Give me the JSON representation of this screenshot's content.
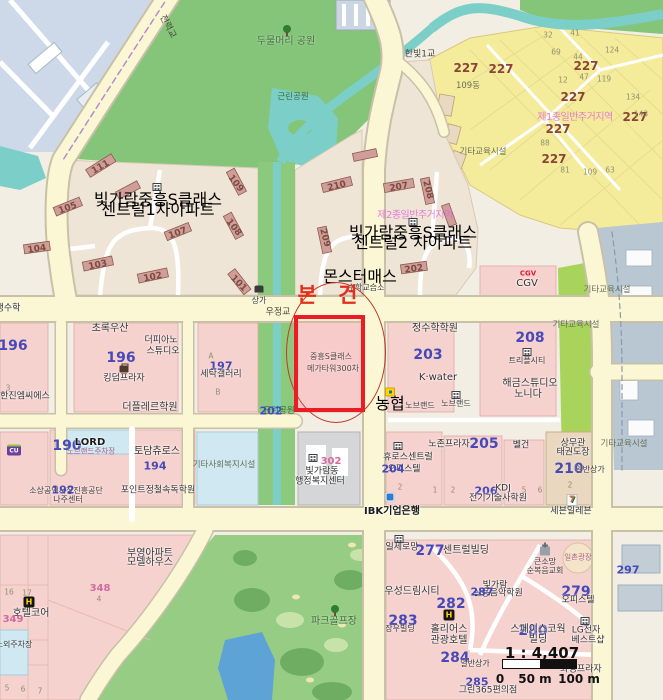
{
  "annotation": {
    "label": "본 건"
  },
  "scale": {
    "ratio": "1 : 4,407",
    "t0": "0",
    "t1": "50 m",
    "t2": "100 m"
  },
  "icons": {
    "hotel": "H",
    "cu": "CU",
    "seven": "7"
  },
  "colors": {
    "subject_box": "#ec1c24",
    "road_fill": "#fbf7d4",
    "park": "#84c57a",
    "water": "#7ccfc9",
    "lake": "#5ea3d6",
    "parcel_pink": "#f6d2cf",
    "parcel_yellow": "#f5ec9b",
    "num_blue": "#4749b8",
    "num_maroon": "#8a4536"
  },
  "labels": [
    {
      "n": "park-dumulmeori",
      "t": "두물머리 공원",
      "x": 286,
      "y": 42,
      "c": "park"
    },
    {
      "n": "park-geunrin-top",
      "t": "근린공원",
      "x": 293,
      "y": 97,
      "c": "park-sm"
    },
    {
      "n": "bridge-jeonryeok",
      "t": "전력교",
      "x": 167,
      "y": 27,
      "c": "road",
      "r": 62
    },
    {
      "n": "bridge-hanbit1",
      "t": "한빛1교",
      "x": 420,
      "y": 55,
      "c": "road"
    },
    {
      "t": "109동",
      "x": 468,
      "y": 86,
      "c": "misc"
    },
    {
      "t": "기타교육시설",
      "x": 483,
      "y": 152,
      "c": "misc"
    },
    {
      "n": "zone-yellow",
      "t": "제1종일반주거지역",
      "x": 575,
      "y": 118,
      "c": "zone"
    },
    {
      "t": "227",
      "x": 466,
      "y": 68,
      "c": "num-maroon"
    },
    {
      "t": "227",
      "x": 501,
      "y": 69,
      "c": "num-maroon"
    },
    {
      "t": "227",
      "x": 586,
      "y": 66,
      "c": "num-maroon"
    },
    {
      "t": "227",
      "x": 573,
      "y": 97,
      "c": "num-maroon"
    },
    {
      "t": "227",
      "x": 558,
      "y": 129,
      "c": "num-maroon"
    },
    {
      "t": "227",
      "x": 635,
      "y": 117,
      "c": "num-maroon"
    },
    {
      "t": "227",
      "x": 554,
      "y": 159,
      "c": "num-maroon"
    },
    {
      "t": "32",
      "x": 548,
      "y": 35,
      "c": "num-gray"
    },
    {
      "t": "41",
      "x": 575,
      "y": 33,
      "c": "num-gray"
    },
    {
      "t": "69",
      "x": 556,
      "y": 52,
      "c": "num-gray"
    },
    {
      "t": "44",
      "x": 578,
      "y": 57,
      "c": "num-gray"
    },
    {
      "t": "12",
      "x": 563,
      "y": 80,
      "c": "num-gray"
    },
    {
      "t": "47",
      "x": 584,
      "y": 77,
      "c": "num-gray"
    },
    {
      "t": "124",
      "x": 612,
      "y": 50,
      "c": "num-gray"
    },
    {
      "t": "119",
      "x": 604,
      "y": 79,
      "c": "num-gray"
    },
    {
      "t": "134",
      "x": 633,
      "y": 97,
      "c": "num-gray"
    },
    {
      "t": "143",
      "x": 641,
      "y": 114,
      "c": "num-gray"
    },
    {
      "t": "88",
      "x": 545,
      "y": 143,
      "c": "num-gray"
    },
    {
      "t": "81",
      "x": 565,
      "y": 170,
      "c": "num-gray"
    },
    {
      "t": "109",
      "x": 590,
      "y": 172,
      "c": "num-gray"
    },
    {
      "t": "63",
      "x": 610,
      "y": 170,
      "c": "num-gray"
    },
    {
      "n": "complex1-name1",
      "t": "빛가람중흥S클래스",
      "x": 158,
      "y": 200,
      "c": "complex"
    },
    {
      "n": "complex1-name2",
      "t": "센트럴1차아파트",
      "x": 158,
      "y": 210,
      "c": "complex"
    },
    {
      "n": "complex2-name1",
      "t": "빛가람중흥S클래스",
      "x": 413,
      "y": 233,
      "c": "complex"
    },
    {
      "n": "complex2-name2",
      "t": "센트럴2 차아파트",
      "x": 413,
      "y": 243,
      "c": "complex"
    },
    {
      "n": "zone-residential2",
      "t": "제2종일반주거지역",
      "x": 415,
      "y": 216,
      "c": "zone"
    },
    {
      "t": "111",
      "x": 101,
      "y": 168,
      "c": "num-bldg",
      "r": -30
    },
    {
      "t": "105",
      "x": 68,
      "y": 209,
      "c": "num-bldg",
      "r": -20
    },
    {
      "t": "104",
      "x": 37,
      "y": 250,
      "c": "num-bldg",
      "r": -8
    },
    {
      "t": "103",
      "x": 98,
      "y": 266,
      "c": "num-bldg",
      "r": -12
    },
    {
      "t": "102",
      "x": 153,
      "y": 278,
      "c": "num-bldg",
      "r": -12
    },
    {
      "t": "107",
      "x": 178,
      "y": 234,
      "c": "num-bldg",
      "r": -20
    },
    {
      "t": "109",
      "x": 235,
      "y": 184,
      "c": "num-bldg",
      "r": 52
    },
    {
      "t": "108",
      "x": 233,
      "y": 228,
      "c": "num-bldg",
      "r": 52
    },
    {
      "t": "101",
      "x": 238,
      "y": 284,
      "c": "num-bldg",
      "r": 45
    },
    {
      "t": "210",
      "x": 337,
      "y": 187,
      "c": "num-bldg",
      "r": -14
    },
    {
      "t": "207",
      "x": 399,
      "y": 188,
      "c": "num-bldg",
      "r": -10
    },
    {
      "t": "208",
      "x": 427,
      "y": 190,
      "c": "num-bldg",
      "r": 75
    },
    {
      "t": "209",
      "x": 324,
      "y": 238,
      "c": "num-bldg",
      "r": 75
    },
    {
      "t": "202",
      "x": 414,
      "y": 270,
      "c": "num-bldg",
      "r": -8
    },
    {
      "n": "poi-monster-math",
      "t": "몬스터매스",
      "x": 360,
      "y": 277,
      "c": "poi"
    },
    {
      "t": "수학교습소",
      "x": 366,
      "y": 288,
      "c": "name-xs"
    },
    {
      "t": "상가",
      "x": 259,
      "y": 301,
      "c": "name-xs"
    },
    {
      "n": "bridge-ujeong",
      "t": "우정교",
      "x": 278,
      "y": 313,
      "c": "road"
    },
    {
      "t": "생수학",
      "x": 8,
      "y": 309,
      "c": "name-sm"
    },
    {
      "t": "196",
      "x": 13,
      "y": 346,
      "c": "num-blue-lg"
    },
    {
      "t": "초록우산",
      "x": 110,
      "y": 329,
      "c": "name"
    },
    {
      "t": "더피아노",
      "x": 161,
      "y": 341,
      "c": "name-sm"
    },
    {
      "t": "스튜디오",
      "x": 163,
      "y": 352,
      "c": "name-sm"
    },
    {
      "t": "196",
      "x": 121,
      "y": 358,
      "c": "num-blue-lg"
    },
    {
      "t": "킹덤프라자",
      "x": 124,
      "y": 379,
      "c": "name-sm"
    },
    {
      "t": "한진엠씨에스",
      "x": 25,
      "y": 397,
      "c": "name-sm"
    },
    {
      "t": "더플레르학원",
      "x": 150,
      "y": 408,
      "c": "name"
    },
    {
      "t": "197",
      "x": 221,
      "y": 366,
      "c": "num-blue"
    },
    {
      "t": "A",
      "x": 211,
      "y": 356,
      "c": "num-gray"
    },
    {
      "t": "B",
      "x": 218,
      "y": 392,
      "c": "num-gray"
    },
    {
      "t": "세탁갤러리",
      "x": 221,
      "y": 375,
      "c": "name-sm"
    },
    {
      "t": "3",
      "x": 8,
      "y": 388,
      "c": "num-gray"
    },
    {
      "n": "poi-jeongsu-academy",
      "t": "정수학학원",
      "x": 435,
      "y": 329,
      "c": "name"
    },
    {
      "t": "203",
      "x": 428,
      "y": 355,
      "c": "num-blue-lg"
    },
    {
      "n": "poi-kwater",
      "t": "K·water",
      "x": 438,
      "y": 378,
      "c": "name"
    },
    {
      "n": "cgv-logo",
      "t": "CGV",
      "x": 528,
      "y": 274,
      "c": "cgv-logo"
    },
    {
      "n": "poi-cgv",
      "t": "CGV",
      "x": 527,
      "y": 284,
      "c": "name"
    },
    {
      "t": "208",
      "x": 530,
      "y": 338,
      "c": "num-blue-lg"
    },
    {
      "t": "트리플시티",
      "x": 527,
      "y": 361,
      "c": "name-xs"
    },
    {
      "t": "해금스튜디오",
      "x": 530,
      "y": 384,
      "c": "name"
    },
    {
      "t": "노니다",
      "x": 528,
      "y": 395,
      "c": "name"
    },
    {
      "t": "노브랜드",
      "x": 420,
      "y": 406,
      "c": "name-xs"
    },
    {
      "t": "노브랜드",
      "x": 456,
      "y": 404,
      "c": "name-xs"
    },
    {
      "n": "poi-nonghyup",
      "t": "농협",
      "x": 390,
      "y": 404,
      "c": "poi"
    },
    {
      "n": "park-geunrin-202",
      "t": "근린공원",
      "x": 279,
      "y": 411,
      "c": "park-sm"
    },
    {
      "t": "202",
      "x": 271,
      "y": 411,
      "c": "num-blue"
    },
    {
      "t": "기타교육시설",
      "x": 607,
      "y": 290,
      "c": "misc"
    },
    {
      "t": "기타교육시설",
      "x": 576,
      "y": 325,
      "c": "misc"
    },
    {
      "t": "기타교육시설",
      "x": 624,
      "y": 444,
      "c": "misc"
    },
    {
      "t": "기타사회복지시설",
      "x": 224,
      "y": 465,
      "c": "misc"
    },
    {
      "t": "302",
      "x": 331,
      "y": 462,
      "c": "num-pink"
    },
    {
      "n": "poi-admin-center1",
      "t": "빛가람동",
      "x": 322,
      "y": 472,
      "c": "name-sm"
    },
    {
      "n": "poi-admin-center2",
      "t": "행정복지센터",
      "x": 320,
      "y": 482,
      "c": "name-sm"
    },
    {
      "t": "190",
      "x": 67,
      "y": 446,
      "c": "num-blue-lg"
    },
    {
      "n": "poi-lord",
      "t": "LORD",
      "x": 90,
      "y": 443,
      "c": "brand"
    },
    {
      "t": "노브랜드주차장",
      "x": 91,
      "y": 451,
      "c": "tiny-pink"
    },
    {
      "t": "토담츄로스",
      "x": 157,
      "y": 452,
      "c": "name"
    },
    {
      "t": "194",
      "x": 155,
      "y": 466,
      "c": "num-blue"
    },
    {
      "t": "소상공인시장진흥공단",
      "x": 66,
      "y": 491,
      "c": "name-xs"
    },
    {
      "t": "192",
      "x": 63,
      "y": 490,
      "c": "num-blue"
    },
    {
      "t": "나주센터",
      "x": 68,
      "y": 500,
      "c": "name-xs"
    },
    {
      "t": "포인트정철속독학원",
      "x": 158,
      "y": 491,
      "c": "name-sm"
    },
    {
      "t": "휴로스센트럴",
      "x": 408,
      "y": 458,
      "c": "name-sm"
    },
    {
      "t": "오피스텔",
      "x": 404,
      "y": 470,
      "c": "name-sm"
    },
    {
      "t": "204",
      "x": 393,
      "y": 469,
      "c": "num-blue"
    },
    {
      "t": "2",
      "x": 400,
      "y": 487,
      "c": "num-gray"
    },
    {
      "t": "노존프라자",
      "x": 449,
      "y": 445,
      "c": "name-sm"
    },
    {
      "t": "205",
      "x": 484,
      "y": 444,
      "c": "num-blue-lg"
    },
    {
      "t": "벨건",
      "x": 521,
      "y": 446,
      "c": "name-sm"
    },
    {
      "t": "상무관",
      "x": 573,
      "y": 444,
      "c": "name-sm"
    },
    {
      "t": "태권도장",
      "x": 573,
      "y": 453,
      "c": "name-sm"
    },
    {
      "t": "210",
      "x": 569,
      "y": 469,
      "c": "num-blue-lg"
    },
    {
      "t": "일반상가",
      "x": 590,
      "y": 470,
      "c": "name-xs"
    },
    {
      "t": "206",
      "x": 486,
      "y": 491,
      "c": "num-blue"
    },
    {
      "t": "KDJ",
      "x": 503,
      "y": 489,
      "c": "name-sm"
    },
    {
      "t": "전기기술사학원",
      "x": 498,
      "y": 499,
      "c": "name-sm"
    },
    {
      "n": "poi-seven-eleven",
      "t": "세븐일레븐",
      "x": 571,
      "y": 512,
      "c": "name-sm"
    },
    {
      "t": "1",
      "x": 435,
      "y": 490,
      "c": "num-gray"
    },
    {
      "t": "2",
      "x": 453,
      "y": 490,
      "c": "num-gray"
    },
    {
      "t": "5",
      "x": 524,
      "y": 490,
      "c": "num-gray"
    },
    {
      "t": "6",
      "x": 540,
      "y": 490,
      "c": "num-gray"
    },
    {
      "t": "2",
      "x": 570,
      "y": 485,
      "c": "num-gray"
    },
    {
      "n": "poi-ibk-bank",
      "t": "IBK기업은행",
      "x": 392,
      "y": 512,
      "c": "brand"
    },
    {
      "t": "일세로망",
      "x": 402,
      "y": 548,
      "c": "name-sm"
    },
    {
      "t": "277",
      "x": 430,
      "y": 551,
      "c": "num-blue-lg"
    },
    {
      "t": "센트럴빌딩",
      "x": 466,
      "y": 551,
      "c": "name"
    },
    {
      "t": "우성드림시티",
      "x": 412,
      "y": 592,
      "c": "name"
    },
    {
      "t": "282",
      "x": 451,
      "y": 604,
      "c": "num-blue-lg"
    },
    {
      "t": "283",
      "x": 403,
      "y": 621,
      "c": "num-blue-lg"
    },
    {
      "t": "장우빌딩",
      "x": 400,
      "y": 629,
      "c": "name-xs"
    },
    {
      "n": "poi-hotel-holius1",
      "t": "홀리어스",
      "x": 449,
      "y": 630,
      "c": "name"
    },
    {
      "n": "poi-hotel-holius2",
      "t": "관광호텔",
      "x": 449,
      "y": 641,
      "c": "name"
    },
    {
      "t": "284",
      "x": 455,
      "y": 658,
      "c": "num-blue-lg"
    },
    {
      "t": "일촌광장",
      "x": 578,
      "y": 557,
      "c": "tiny-pink"
    },
    {
      "t": "큰소망",
      "x": 545,
      "y": 562,
      "c": "name-xs"
    },
    {
      "t": "순복음교회",
      "x": 545,
      "y": 571,
      "c": "name-xs"
    },
    {
      "t": "297",
      "x": 628,
      "y": 570,
      "c": "num-blue"
    },
    {
      "t": "빛가람",
      "x": 495,
      "y": 586,
      "c": "name-sm"
    },
    {
      "t": "실용음악학원",
      "x": 498,
      "y": 594,
      "c": "name-sm"
    },
    {
      "t": "287",
      "x": 482,
      "y": 592,
      "c": "num-blue"
    },
    {
      "t": "279",
      "x": 576,
      "y": 592,
      "c": "num-blue-lg"
    },
    {
      "t": "오피스텔",
      "x": 578,
      "y": 601,
      "c": "name-sm"
    },
    {
      "t": "280",
      "x": 533,
      "y": 631,
      "c": "num-blue-lg"
    },
    {
      "t": "스페이스코웍",
      "x": 538,
      "y": 630,
      "c": "name"
    },
    {
      "t": "빌딩",
      "x": 538,
      "y": 640,
      "c": "name"
    },
    {
      "n": "poi-lg1",
      "t": "LG전자",
      "x": 586,
      "y": 631,
      "c": "name-sm"
    },
    {
      "n": "poi-lg2",
      "t": "베스트샵",
      "x": 588,
      "y": 641,
      "c": "name-sm"
    },
    {
      "t": "화정프라자",
      "x": 581,
      "y": 670,
      "c": "name-sm"
    },
    {
      "t": "일반상가",
      "x": 475,
      "y": 664,
      "c": "name-xs"
    },
    {
      "t": "285",
      "x": 477,
      "y": 682,
      "c": "num-blue"
    },
    {
      "t": "그린365편의점",
      "x": 488,
      "y": 691,
      "c": "name-sm"
    },
    {
      "t": "부영아파트",
      "x": 150,
      "y": 554,
      "c": "name"
    },
    {
      "t": "모델하우스",
      "x": 150,
      "y": 563,
      "c": "name"
    },
    {
      "t": "348",
      "x": 100,
      "y": 589,
      "c": "num-pink"
    },
    {
      "t": "4",
      "x": 99,
      "y": 599,
      "c": "num-gray"
    },
    {
      "n": "poi-hotel-core",
      "t": "호텔코어",
      "x": 31,
      "y": 614,
      "c": "name"
    },
    {
      "t": "349",
      "x": 13,
      "y": 620,
      "c": "num-pink"
    },
    {
      "t": "16",
      "x": 9,
      "y": 592,
      "c": "num-gray"
    },
    {
      "t": "17",
      "x": 27,
      "y": 593,
      "c": "num-gray"
    },
    {
      "t": "노외주차장",
      "x": 14,
      "y": 645,
      "c": "name-xs"
    },
    {
      "t": "5",
      "x": 7,
      "y": 688,
      "c": "num-gray"
    },
    {
      "t": "6",
      "x": 23,
      "y": 689,
      "c": "num-gray"
    },
    {
      "t": "7",
      "x": 40,
      "y": 691,
      "c": "num-gray"
    },
    {
      "n": "park-golf",
      "t": "파크골프장",
      "x": 334,
      "y": 622,
      "c": "park"
    },
    {
      "n": "subject-name1",
      "t": "중흥S클래스",
      "x": 331,
      "y": 357,
      "c": "name-xs"
    },
    {
      "n": "subject-name2",
      "t": "메가타워300차",
      "x": 333,
      "y": 369,
      "c": "name-xs"
    }
  ]
}
